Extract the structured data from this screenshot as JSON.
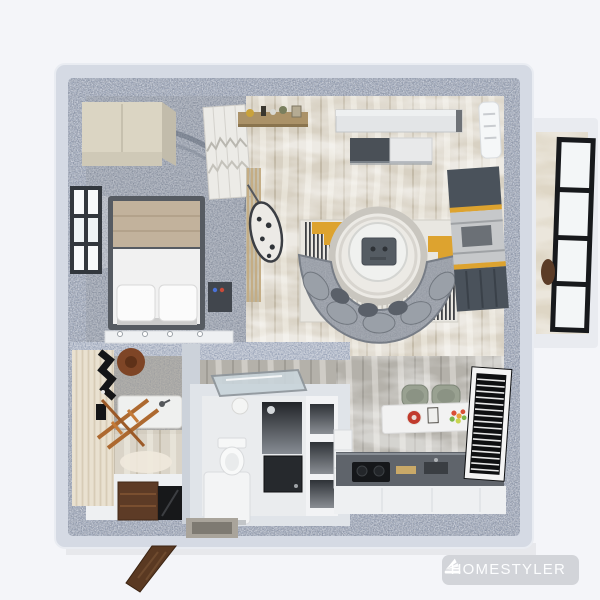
{
  "app": {
    "watermark_brand": "HOMESTYLER"
  },
  "palette": {
    "bg": "#f4f5f9",
    "wall_top": "#d5dae4",
    "wall_speckle": "#9aa4b8",
    "floor_marble": "#d8d1c3",
    "floor_kitchen_marble": "#b4b1aa",
    "bedroom_floor": "#939baa",
    "balcony_floor": "#ded6c5",
    "balcony_outer": "#e9ebf0",
    "accent_yellow": "#dda32f",
    "sofa_gray": "#a4a9b1",
    "wood_shelf": "#ab9268",
    "dark_wood_door": "#5a3922",
    "black_frame": "#17191c",
    "white_furniture": "#f1f2f3",
    "desk_dark": "#4a525b",
    "watermark_pill": "#d2d4d9",
    "watermark_text": "#fcfdfe"
  },
  "scene": {
    "type": "top-down 3d apartment floorplan render",
    "rooms": [
      {
        "name": "bedroom",
        "furniture": [
          "cream-wardrobe",
          "double-bed-with-pillows",
          "side-window",
          "shag-rug",
          "bedside-table",
          "wavy-print-cabinet",
          "low-shelf"
        ]
      },
      {
        "name": "living-room",
        "furniture": [
          "wall-shelf-with-trinkets",
          "tv-panel",
          "tv-cabinet",
          "geometric-rug",
          "round-coffee-table",
          "curved-sofa",
          "desk-unit",
          "air-conditioner",
          "slat-partition",
          "hanging-chair"
        ]
      },
      {
        "name": "balcony",
        "furniture": [
          "black-framed-glazing",
          "chair"
        ]
      },
      {
        "name": "kitchen",
        "furniture": [
          "dining-bar-with-food",
          "two-chairs",
          "counter-with-stove-and-sink",
          "tall-cabinet",
          "louvered-window"
        ]
      },
      {
        "name": "bathroom",
        "furniture": [
          "striped-wall",
          "wall-rack",
          "round-hat",
          "ladder-towel-rack",
          "tub-counter",
          "wood-vanity",
          "dark-mirror"
        ]
      },
      {
        "name": "wc",
        "furniture": [
          "glass-screen",
          "ceiling-lamp",
          "toilet",
          "white-bench",
          "shower-column",
          "appliance-box",
          "wall-niches"
        ]
      },
      {
        "name": "entry",
        "furniture": [
          "open-wood-door",
          "marble-threshold"
        ]
      }
    ]
  }
}
